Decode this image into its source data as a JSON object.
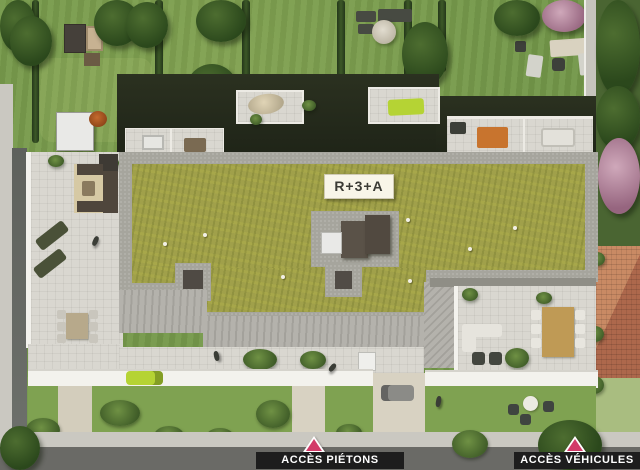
{
  "labels": {
    "lot": "R+3+A",
    "pedestrian": "ACCÈS PIÉTONS",
    "vehicle": "ACCÈS VÉHICULES"
  },
  "palette": {
    "lawn": "#74984a",
    "lawnSouth": "#7fa251",
    "lawnPale": "#a9bd80",
    "hedge": "#2f4a22",
    "roofGreen": "#a0a04a",
    "gravel": "#a6a59d",
    "paving": "#d9d7d0",
    "stripeA": "#b4b2ac",
    "stripeB": "#a3a19b",
    "road": "#6a6a66",
    "sidewalk": "#cac8c1",
    "wallWhite": "#f3f2ed",
    "labelBg": "#1d1d1d",
    "labelText": "#ffffff",
    "marker": "#d23a68",
    "roofLabelBg": "#f8f5e8",
    "roofLabelText": "#3b3b35",
    "terracotta": "#bd7b5b",
    "lime": "#b5d334",
    "carGray": "#8b8b87",
    "woodDark": "#4f463c",
    "tableWood": "#bf9a55",
    "orangeRug": "#c8742e"
  }
}
